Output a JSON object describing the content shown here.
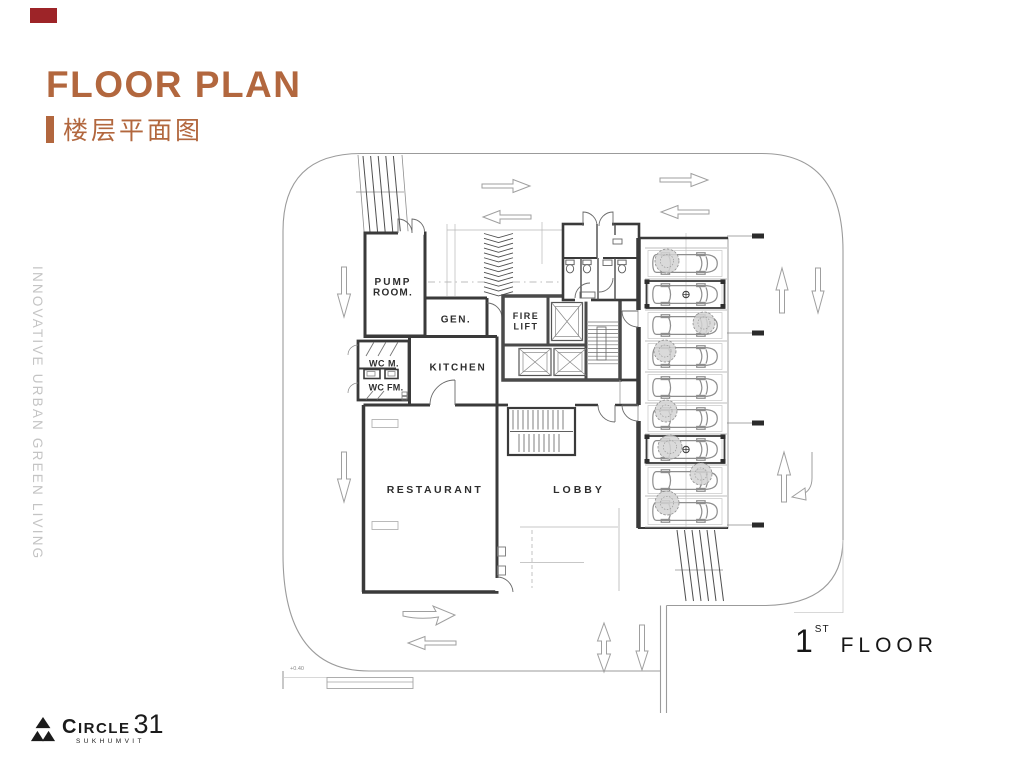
{
  "slide": {
    "title": "FLOOR PLAN",
    "subtitle": "楼层平面图",
    "side_tagline": "INNOVATIVE URBAN GREEN LIVING",
    "accent_color": "#b2673e",
    "marker_color": "#9d2428"
  },
  "plan": {
    "floor_number": "1",
    "floor_suffix": "ST",
    "floor_word": "FLOOR",
    "level_note": "+0.40",
    "rooms": {
      "pump_line1": "PUMP",
      "pump_line2": "ROOM.",
      "gen": "GEN.",
      "fire_line1": "FIRE",
      "fire_line2": "LIFT",
      "kitchen": "KITCHEN",
      "wc_m": "WC M.",
      "wc_fm": "WC FM.",
      "restaurant": "RESTAURANT",
      "lobby": "LOBBY"
    }
  },
  "logo": {
    "brand": "CIRCLE",
    "number": "31",
    "sub": "SUKHUMVIT"
  }
}
